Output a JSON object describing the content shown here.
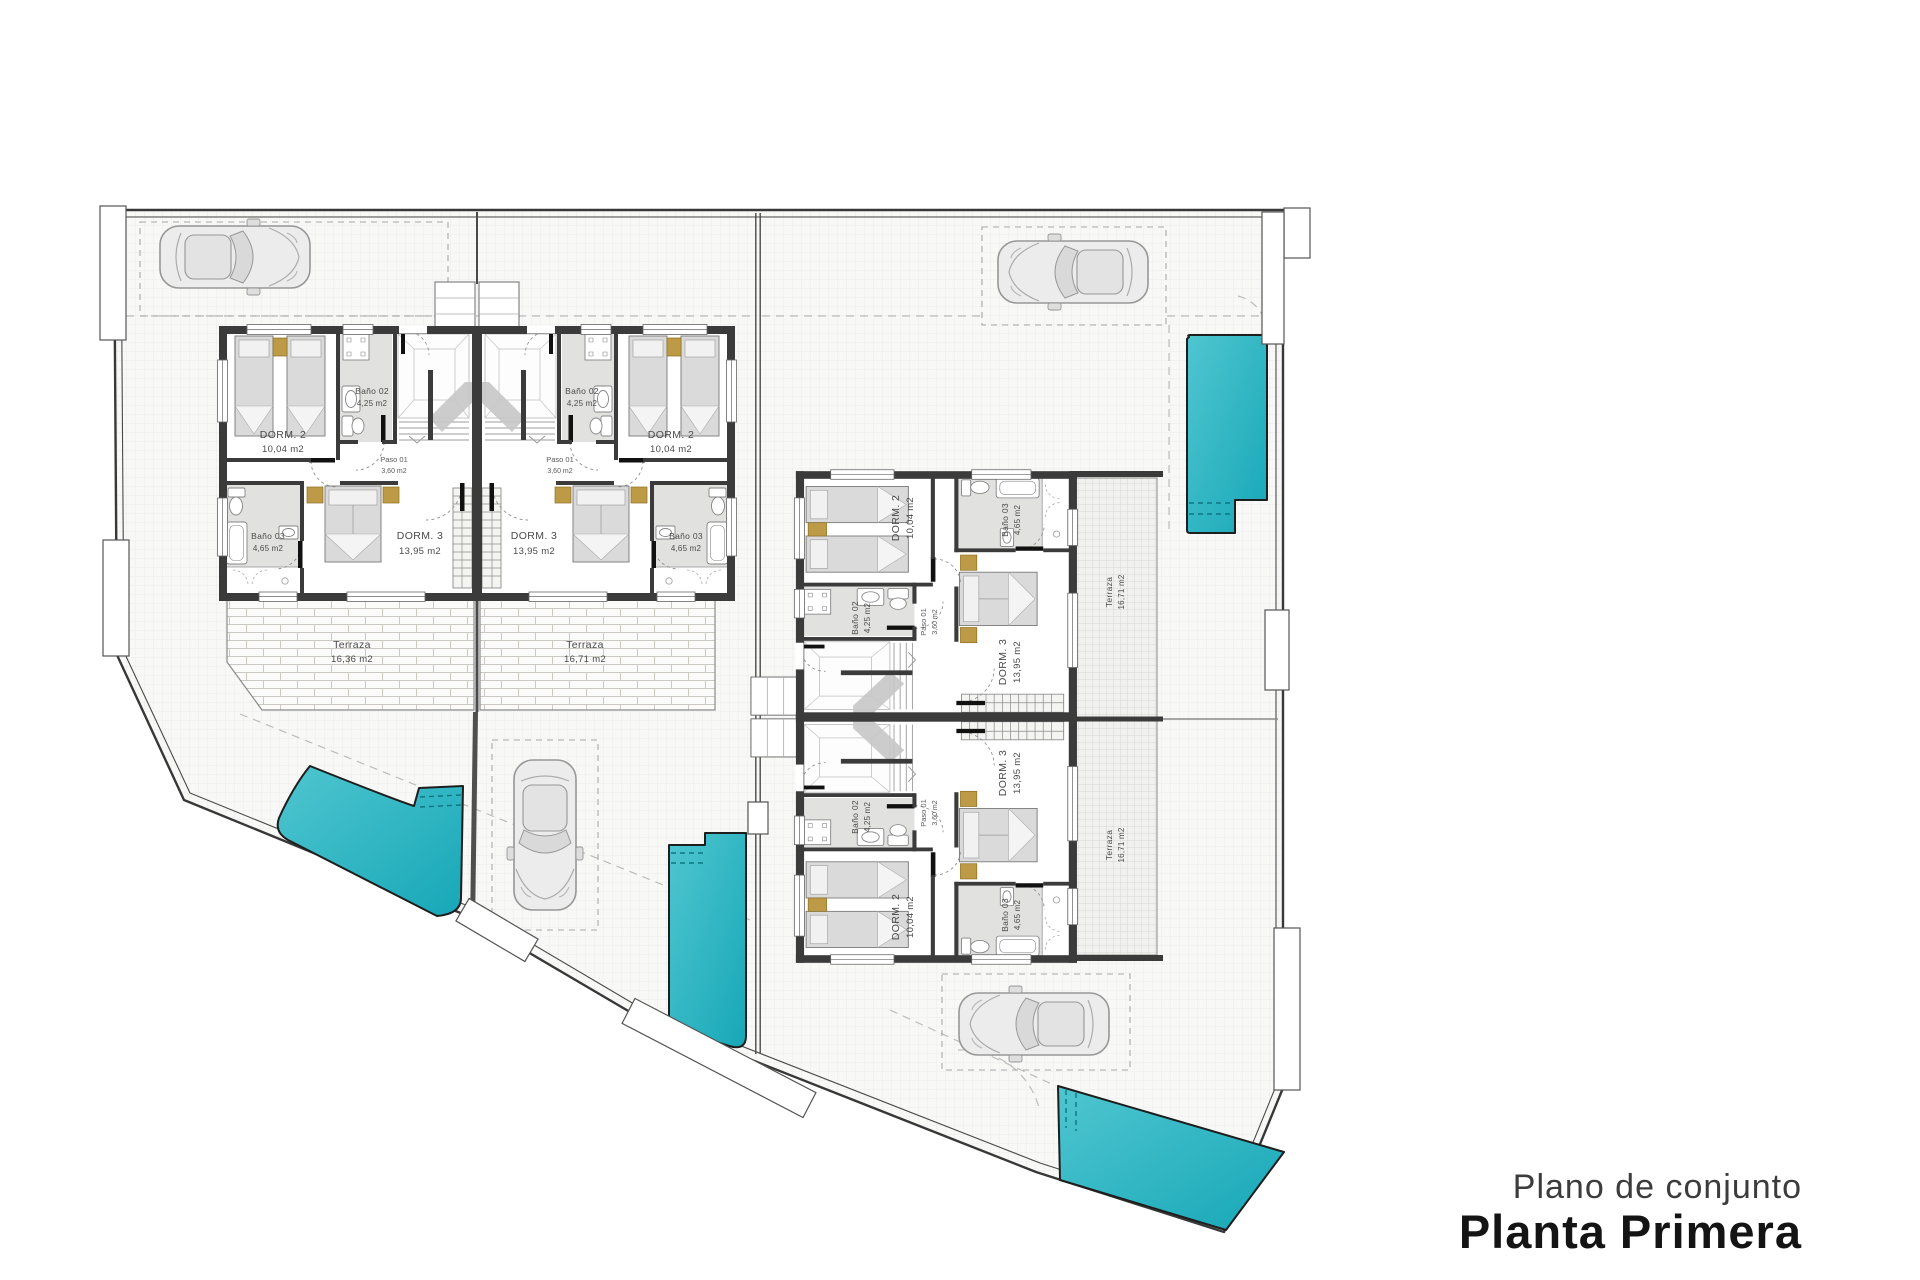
{
  "title": {
    "subtitle": "Plano de conjunto",
    "main": "Planta Primera"
  },
  "rooms": {
    "dorm2": {
      "name": "DORM. 2",
      "area": "10,04 m2"
    },
    "dorm3": {
      "name": "DORM. 3",
      "area": "13,95 m2"
    },
    "bano02": {
      "name": "Baño 02",
      "area": "4,25 m2"
    },
    "bano03": {
      "name": "Baño 03",
      "area": "4,65 m2"
    },
    "paso01": {
      "name": "Paso 01",
      "area": "3,60 m2"
    },
    "terraza_left": {
      "name": "Terraza",
      "area": "16,36 m2"
    },
    "terraza_right": {
      "name": "Terraza",
      "area": "16,71 m2"
    },
    "terraza_east": {
      "name": "Terraza",
      "area": "16,71 m2"
    }
  },
  "colors": {
    "pool_light": "#4fc6d0",
    "pool_deep": "#17a7b7",
    "wall": "#3b3b3b",
    "bath_floor": "#e1e1e0",
    "furniture_accent": "#bd9a46"
  },
  "icons": {
    "cars": [
      "car-top-left",
      "car-top-right",
      "car-center",
      "car-bottom"
    ],
    "pools": [
      "pool-northeast",
      "pool-west",
      "pool-center",
      "pool-southeast"
    ]
  }
}
